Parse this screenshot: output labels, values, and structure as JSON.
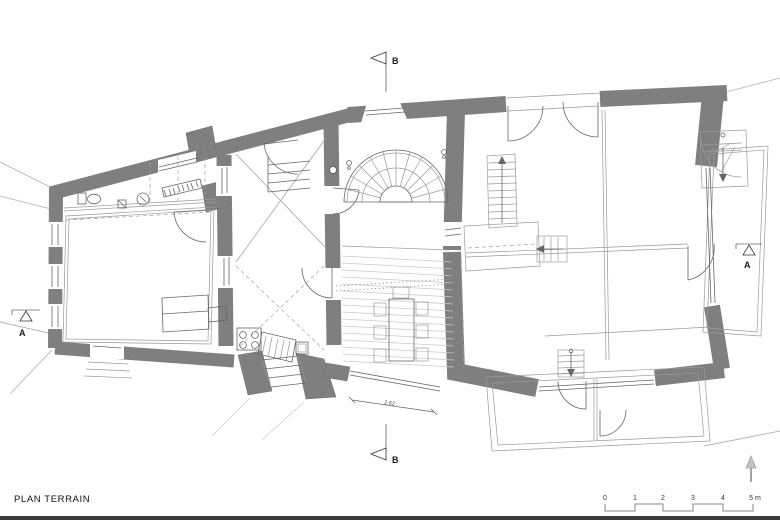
{
  "title": "PLAN TERRAIN",
  "section_markers": {
    "top": {
      "label": "B"
    },
    "bottom": {
      "label": "B"
    },
    "left": {
      "label": "A"
    },
    "right": {
      "label": "A"
    }
  },
  "dimension": {
    "value": "2.62"
  },
  "scale_bar": {
    "unit": "m",
    "ticks": [
      "0",
      "1",
      "2",
      "3",
      "4",
      "5 m"
    ]
  },
  "north_arrow": {
    "icon": "north-arrow-icon",
    "direction": "up"
  },
  "colors": {
    "wall": "#7f7f7f",
    "thin_line": "#666666",
    "light_line": "#9a9a9a",
    "terrain_line": "#b5b5b5",
    "background": "#ffffff",
    "text": "#1a1a1a"
  }
}
